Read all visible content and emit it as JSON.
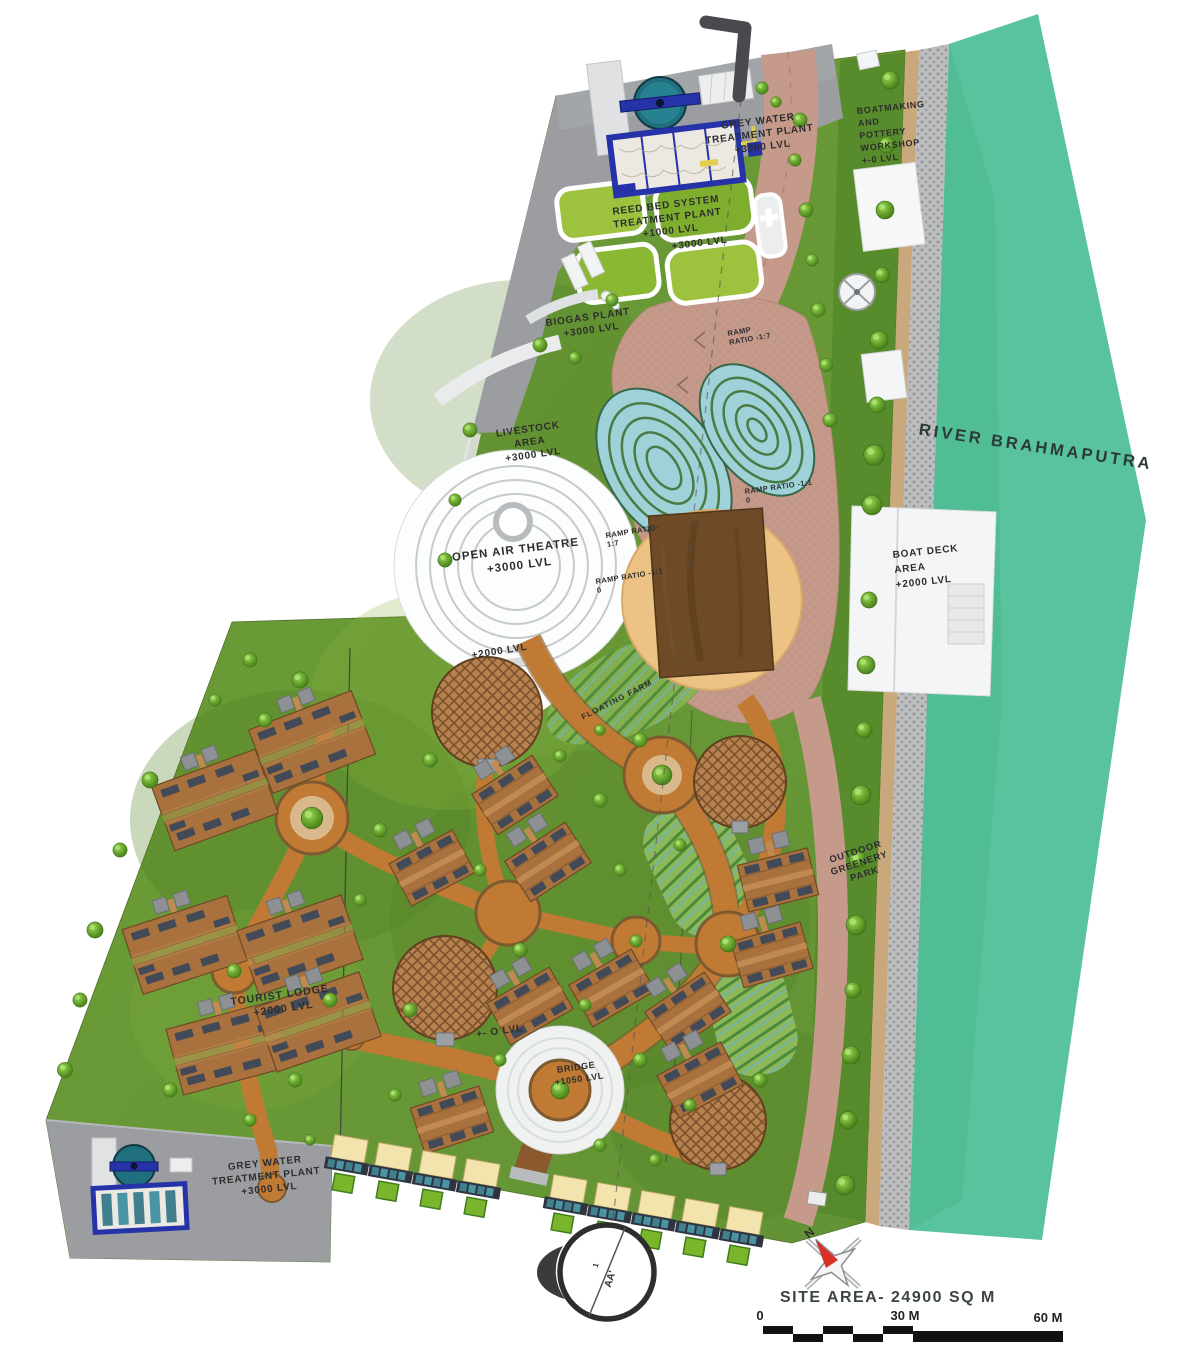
{
  "labels": {
    "grey_water_top": {
      "lines": [
        "GREY WATER",
        "TREATMENT PLANT",
        "+3000 LVL"
      ]
    },
    "reed_bed": {
      "lines": [
        "REED BED SYSTEM",
        "TREATMENT PLANT",
        "+1000 LVL"
      ]
    },
    "reed_bed_level": {
      "text": "+3000 LVL"
    },
    "boatmaking": {
      "lines": [
        "BOATMAKING",
        "AND",
        "POTTERY",
        "WORKSHOP",
        "+-0 LVL"
      ]
    },
    "biogas": {
      "lines": [
        "BIOGAS PLANT",
        "+3000 LVL"
      ]
    },
    "livestock": {
      "lines": [
        "LIVESTOCK",
        "AREA",
        "+3000 LVL"
      ]
    },
    "ramp_top": {
      "lines": [
        "RAMP",
        "RATIO -1:7"
      ]
    },
    "ramp_mid": {
      "lines": [
        "RAMP RATIO-",
        "1:7"
      ]
    },
    "ramp_left": {
      "lines": [
        "RAMP RATIO -1:1",
        "0"
      ]
    },
    "ramp_right": {
      "lines": [
        "RAMP RATIO -1:1",
        "0"
      ]
    },
    "theatre": {
      "lines": [
        "OPEN AIR THEATRE",
        "+3000 LVL"
      ]
    },
    "theatre_lower_level": {
      "text": "+2000 LVL"
    },
    "boat_deck": {
      "lines": [
        "BOAT DECK",
        "AREA",
        "+2000 LVL"
      ]
    },
    "river": {
      "text": "RIVER BRAHMAPUTRA"
    },
    "floating_farm": {
      "text": "FLOATING FARM"
    },
    "outdoor_park": {
      "lines": [
        "OUTDOOR",
        "GREENERY",
        "PARK"
      ]
    },
    "tourist_lodge": {
      "lines": [
        "TOURIST LODGE",
        "+2000 LVL"
      ]
    },
    "ground_level": {
      "text": "+- O LVL"
    },
    "bridge": {
      "lines": [
        "BRIDGE",
        "+1050 LVL"
      ]
    },
    "grey_water_bottom": {
      "lines": [
        "GREY WATER",
        "TREATMENT PLANT",
        "+3000 LVL"
      ]
    },
    "site_area": {
      "text": "SITE AREA- 24900 SQ M"
    },
    "north": {
      "text": "N"
    },
    "section": {
      "number": "1",
      "name": "AA'"
    },
    "scale_bar": {
      "start": "0",
      "mid": "30 M",
      "end": "60 M"
    }
  },
  "colors": {
    "river": "#58c39c",
    "grass": "#68962e",
    "grass_dark": "#55892b",
    "path_orange": "#c07a33",
    "plaza_pink": "#c59a8b",
    "sand": "#c9a87c",
    "concrete_grey": "#9b9da0",
    "roof_brown": "#a9713d",
    "pavilion_brown": "#6e4a26",
    "tank_blue": "#2633a8",
    "pond_teal": "#9fd2d8",
    "deck_white": "#f4f5f6"
  }
}
